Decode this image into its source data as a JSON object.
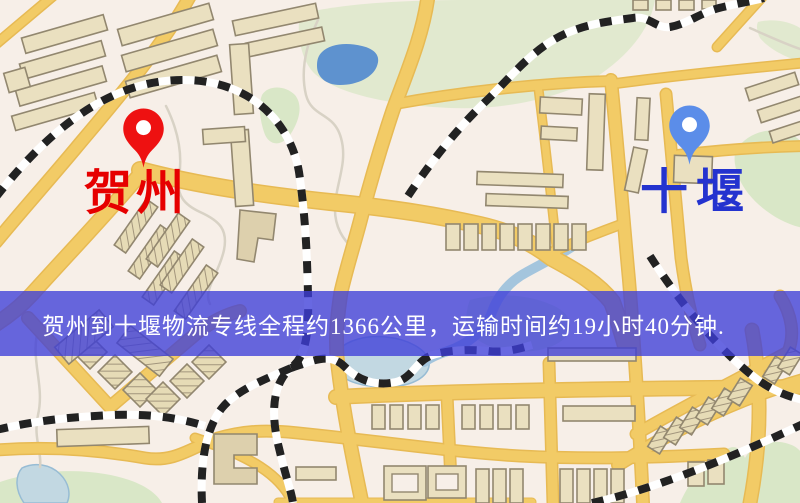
{
  "map": {
    "origin": {
      "name": "贺州"
    },
    "destination": {
      "name": "十堰"
    },
    "banner": {
      "text": "贺州到十堰物流专线全程约1366公里，运输时间约19小时40分钟."
    },
    "colors": {
      "background": "#f7efe8",
      "road": "#f2cb66",
      "road_casing": "#e7ba54",
      "green": "#d9e7c7",
      "water_dark": "#5e92cf",
      "water_light": "#c2d8e2",
      "river": "#a4c5dd",
      "railway": "#222222",
      "rail_base": "#ffffff",
      "building_fill": "#eae0c0",
      "building_stroke": "#92876f",
      "building_dark": "#ddd0ad",
      "stream": "#d8d2c5",
      "origin_marker": "#ee1111",
      "origin_label": "#e60000",
      "destination_marker": "#5b8de9",
      "destination_label": "#2433cf",
      "banner_bg": "rgba(62,62,216,0.78)",
      "banner_text": "#ffffff"
    }
  }
}
